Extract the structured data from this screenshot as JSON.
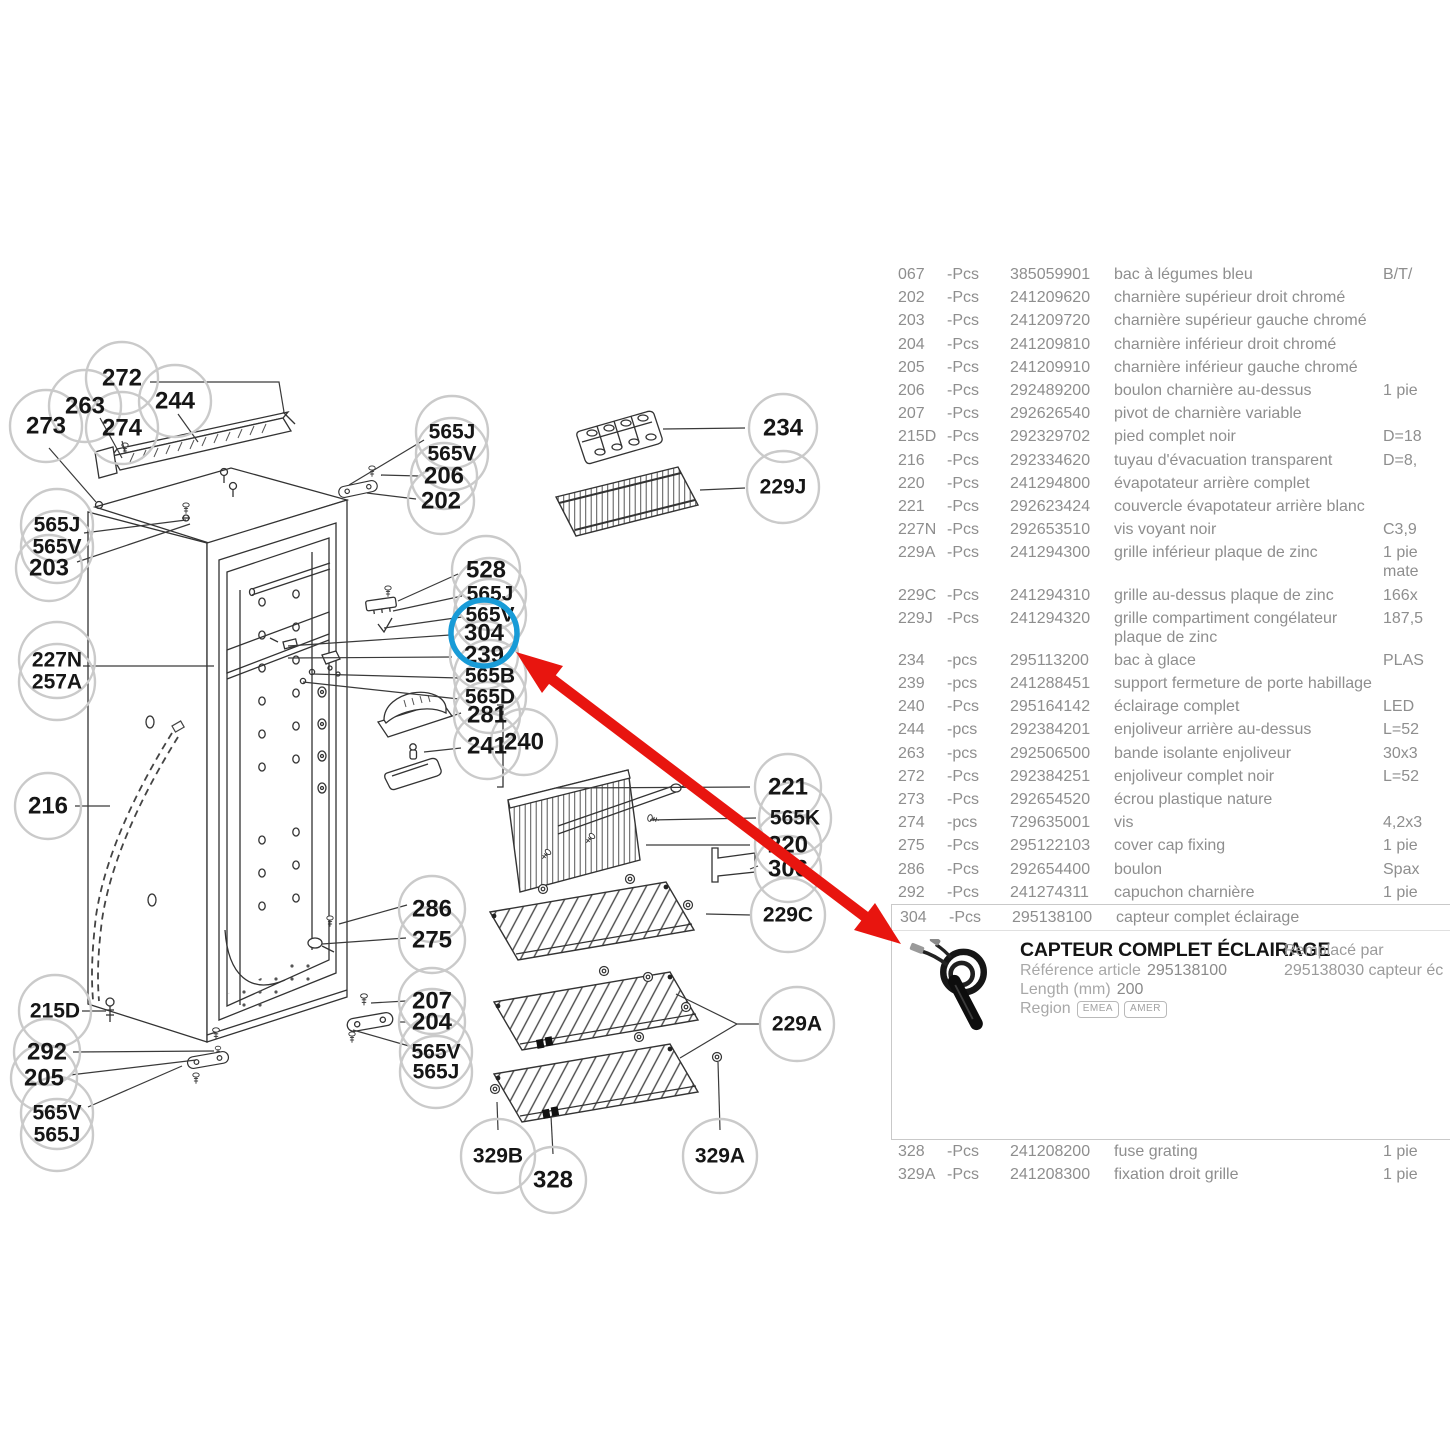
{
  "colors": {
    "accent_red": "#e8150f",
    "highlight_blue": "#189bd7"
  },
  "diagram": {
    "highlighted_callout": "304",
    "labels": [
      "272",
      "263",
      "273",
      "274",
      "244",
      "565J",
      "565V",
      "206",
      "202",
      "565J",
      "565V",
      "203",
      "528",
      "565J",
      "565V",
      "304",
      "239",
      "565B",
      "565D",
      "281",
      "241",
      "240",
      "227N",
      "257A",
      "216",
      "286",
      "275",
      "215D",
      "292",
      "205",
      "565V",
      "565J",
      "207",
      "204",
      "565V",
      "565J",
      "329B",
      "328",
      "329A",
      "234",
      "229J",
      "221",
      "565K",
      "220",
      "306",
      "229C",
      "229A"
    ]
  },
  "parts_table": {
    "rows_before": [
      {
        "pos": "067",
        "qty": "-Pcs",
        "ref": "385059901",
        "desc": "bac à légumes bleu",
        "info": "B/T/"
      },
      {
        "pos": "202",
        "qty": "-Pcs",
        "ref": "241209620",
        "desc": "charnière supérieur droit chromé",
        "info": ""
      },
      {
        "pos": "203",
        "qty": "-Pcs",
        "ref": "241209720",
        "desc": "charnière supérieur gauche chromé",
        "info": ""
      },
      {
        "pos": "204",
        "qty": "-Pcs",
        "ref": "241209810",
        "desc": "charnière inférieur droit chromé",
        "info": ""
      },
      {
        "pos": "205",
        "qty": "-Pcs",
        "ref": "241209910",
        "desc": "charnière inférieur gauche chromé",
        "info": ""
      },
      {
        "pos": "206",
        "qty": "-Pcs",
        "ref": "292489200",
        "desc": "boulon charnière au-dessus",
        "info": "1 pie"
      },
      {
        "pos": "207",
        "qty": "-Pcs",
        "ref": "292626540",
        "desc": "pivot de charnière variable",
        "info": ""
      },
      {
        "pos": "215D",
        "qty": "-Pcs",
        "ref": "292329702",
        "desc": "pied complet noir",
        "info": "D=18"
      },
      {
        "pos": "216",
        "qty": "-Pcs",
        "ref": "292334620",
        "desc": "tuyau d'évacuation transparent",
        "info": "D=8,"
      },
      {
        "pos": "220",
        "qty": "-Pcs",
        "ref": "241294800",
        "desc": "évapotateur arrière complet",
        "info": ""
      },
      {
        "pos": "221",
        "qty": "-Pcs",
        "ref": "292623424",
        "desc": "couvercle évapotateur arrière blanc",
        "info": ""
      },
      {
        "pos": "227N",
        "qty": "-Pcs",
        "ref": "292653510",
        "desc": "vis voyant noir",
        "info": "C3,9"
      },
      {
        "pos": "229A",
        "qty": "-Pcs",
        "ref": "241294300",
        "desc": "grille inférieur plaque de zinc",
        "info": "1 pie\nmate"
      },
      {
        "pos": "229C",
        "qty": "-Pcs",
        "ref": "241294310",
        "desc": "grille au-dessus plaque de zinc",
        "info": "166x"
      },
      {
        "pos": "229J",
        "qty": "-Pcs",
        "ref": "241294320",
        "desc": "grille compartiment congélateur plaque de zinc",
        "info": "187,5"
      },
      {
        "pos": "234",
        "qty": "-pcs",
        "ref": "295113200",
        "desc": "bac à glace",
        "info": "PLAS"
      },
      {
        "pos": "239",
        "qty": "-pcs",
        "ref": "241288451",
        "desc": "support fermeture de porte habillage",
        "info": ""
      },
      {
        "pos": "240",
        "qty": "-Pcs",
        "ref": "295164142",
        "desc": "éclairage complet",
        "info": "LED"
      },
      {
        "pos": "244",
        "qty": "-pcs",
        "ref": "292384201",
        "desc": "enjoliveur arrière au-dessus",
        "info": "L=52"
      },
      {
        "pos": "263",
        "qty": "-pcs",
        "ref": "292506500",
        "desc": "bande isolante enjoliveur",
        "info": "30x3"
      },
      {
        "pos": "272",
        "qty": "-Pcs",
        "ref": "292384251",
        "desc": "enjoliveur complet noir",
        "info": "L=52"
      },
      {
        "pos": "273",
        "qty": "-Pcs",
        "ref": "292654520",
        "desc": "écrou plastique nature",
        "info": ""
      },
      {
        "pos": "274",
        "qty": "-pcs",
        "ref": "729635001",
        "desc": "vis",
        "info": "4,2x3"
      },
      {
        "pos": "275",
        "qty": "-Pcs",
        "ref": "295122103",
        "desc": "cover cap fixing",
        "info": "1 pie"
      },
      {
        "pos": "286",
        "qty": "-Pcs",
        "ref": "292654400",
        "desc": "boulon",
        "info": "Spax"
      },
      {
        "pos": "292",
        "qty": "-Pcs",
        "ref": "241274311",
        "desc": "capuchon charnière",
        "info": "1 pie"
      }
    ],
    "rows_after": [
      {
        "pos": "328",
        "qty": "-Pcs",
        "ref": "241208200",
        "desc": "fuse grating",
        "info": "1 pie"
      },
      {
        "pos": "329A",
        "qty": "-Pcs",
        "ref": "241208300",
        "desc": "fixation droit grille",
        "info": "1 pie"
      }
    ]
  },
  "detail_panel": {
    "row": {
      "pos": "304",
      "qty": "-Pcs",
      "ref": "295138100",
      "desc": "capteur complet éclairage",
      "info": ""
    },
    "title": "CAPTEUR COMPLET ÉCLAIRAGE",
    "field1_label": "Référence article",
    "field1_value": "295138100",
    "field2_label": "Length (mm)",
    "field2_value": "200",
    "region_label": "Region",
    "badge1": "EMEA",
    "badge2": "AMER",
    "replaced_label": "Remplacé par",
    "replaced_value": "295138030 capteur éc"
  }
}
